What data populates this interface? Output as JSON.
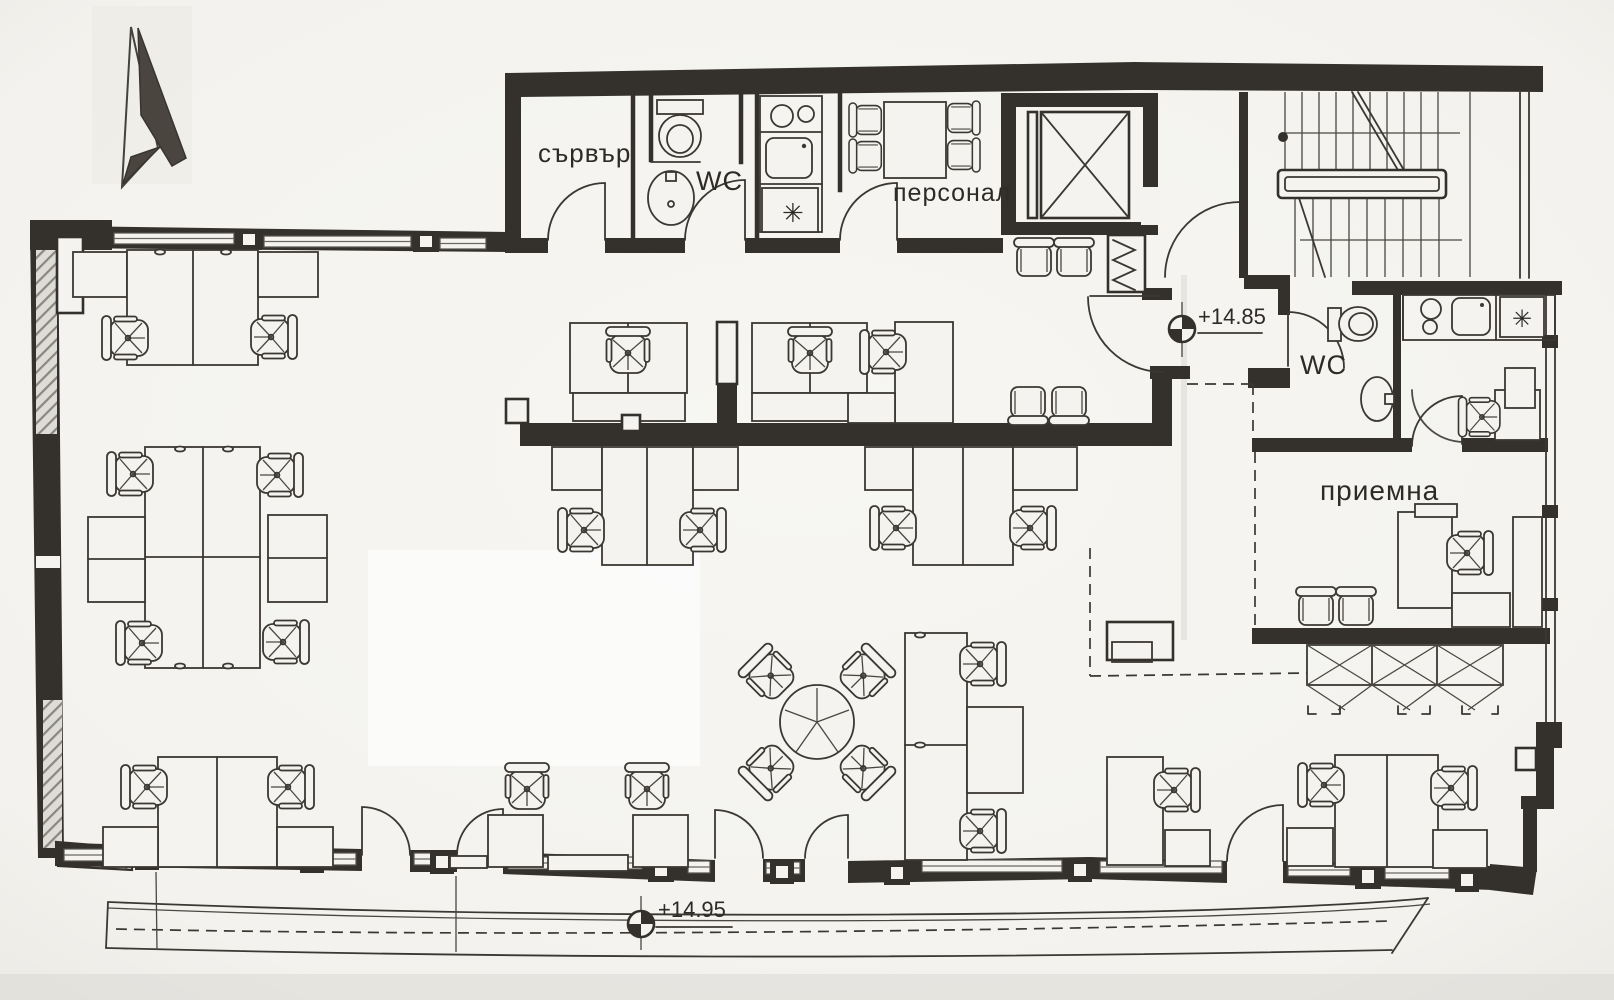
{
  "plan": {
    "kind": "office floor plan (scanned architectural drawing)",
    "rooms": {
      "server": {
        "label": "сървър"
      },
      "wc_top": {
        "label": "WC"
      },
      "staff": {
        "label": "персонал"
      },
      "wc_right": {
        "label": "WC"
      },
      "reception": {
        "label": "приемна"
      }
    },
    "levels": {
      "entrance_landing": "+14.85",
      "terrace": "+14.95"
    },
    "icons": {
      "fridge": "✳",
      "north_arrow": "north-arrow-icon",
      "elevator": "elevator-shaft-icon",
      "stairs": "stairs-icon",
      "level_marker": "level-marker-icon"
    },
    "colors": {
      "paper": "#f4f3f0",
      "ink": "#34312c"
    }
  }
}
